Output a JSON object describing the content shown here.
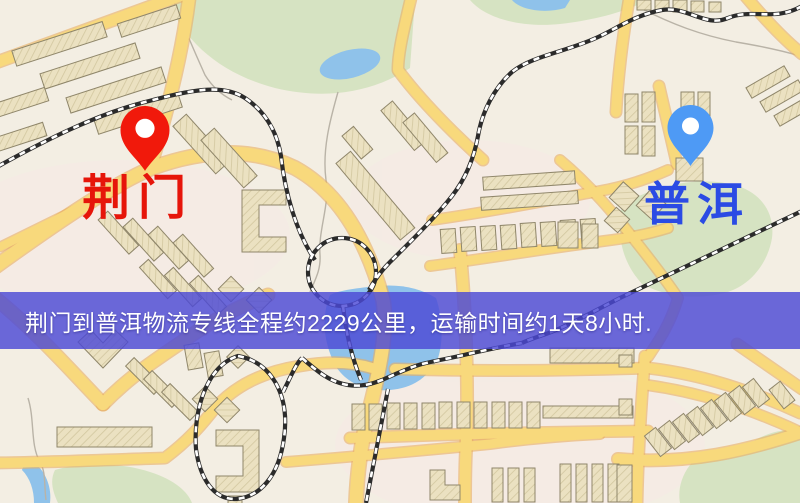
{
  "palette": {
    "bg": "#f3eee3",
    "road": "#f8d97c",
    "road_edge": "#e7ae61",
    "building": "#ebe1c1",
    "building_line": "#8f866a",
    "park": "#d6e3c2",
    "water": "#8fc2ea",
    "stream": "#b9b3a7",
    "railway": "#2b2b2b",
    "railway_tie": "#ffffff",
    "banner_bg": "#4c49d5",
    "banner_text": "#ffffff",
    "origin_text": "#e6150a",
    "destination_text": "#2b4be4",
    "origin_pin": "#f1190b",
    "destination_pin": "#4e9af5",
    "pin_hole": "#ffffff"
  },
  "map": {
    "origin": {
      "label": "荆门"
    },
    "destination": {
      "label": "普洱"
    }
  },
  "banner": {
    "text": "荆门到普洱物流专线全程约2229公里，运输时间约1天8小时."
  }
}
